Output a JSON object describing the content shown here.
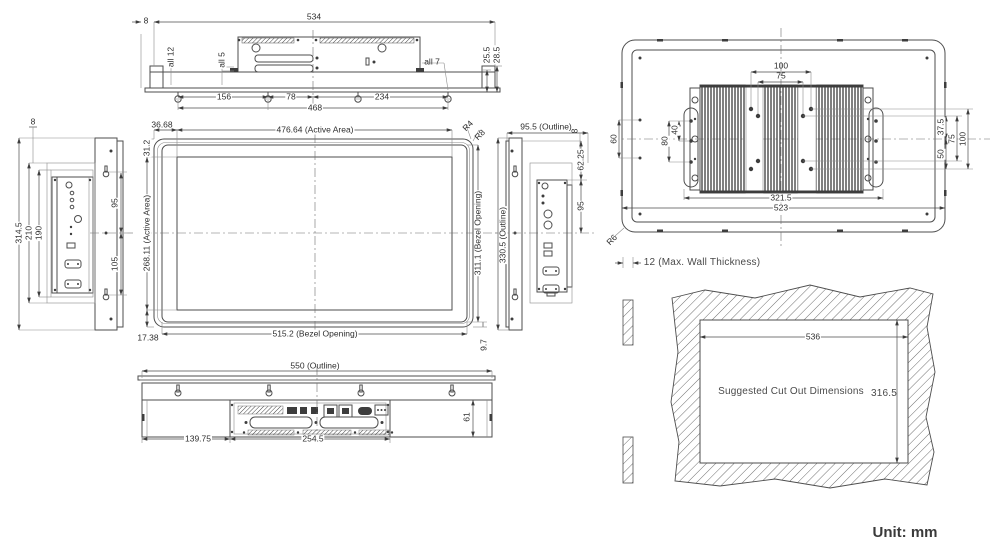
{
  "unit": "Unit: mm",
  "top": {
    "d534": "534",
    "d8": "8",
    "all12": "all 12",
    "all5": "all 5",
    "all7": "all 7",
    "d25_5": "25.5",
    "d28_5": "28.5",
    "d156": "156",
    "d78": "78",
    "d234": "234",
    "d468": "468"
  },
  "left": {
    "d8": "8",
    "d314_5": "314.5",
    "d210": "210",
    "d190": "190",
    "d95": "95",
    "d105": "105"
  },
  "front": {
    "d36_68": "36.68",
    "active_w": "476.64 (Active Area)",
    "r4": "R4",
    "r8": "R8",
    "d31_2": "31.2",
    "active_h": "268.11 (Active Area)",
    "d17_38": "17.38",
    "bezel_w": "515.2 (Bezel Opening)",
    "d9_7": "9.7",
    "bezel_h": "311.1 (Bezel Opening)"
  },
  "right": {
    "outline_w": "95.5 (Outline)",
    "d8": "8",
    "d62_25": "62.25",
    "d95": "95",
    "outline_h": "330.5 (Outline)"
  },
  "bottom": {
    "outline_w": "550 (Outline)",
    "d139_75": "139.75",
    "d254_5": "254.5",
    "d61": "61"
  },
  "rear": {
    "d100": "100",
    "d75": "75",
    "d60": "60",
    "d80": "80",
    "d40": "40",
    "d321_5": "321.5",
    "d523": "523",
    "d37_5": "37.5",
    "v75": "75",
    "v100": "100",
    "d50": "50",
    "r6": "R6"
  },
  "cutout": {
    "wall": "12 (Max. Wall Thickness)",
    "label": "Suggested Cut Out Dimensions",
    "w": "536",
    "h": "316.5"
  }
}
